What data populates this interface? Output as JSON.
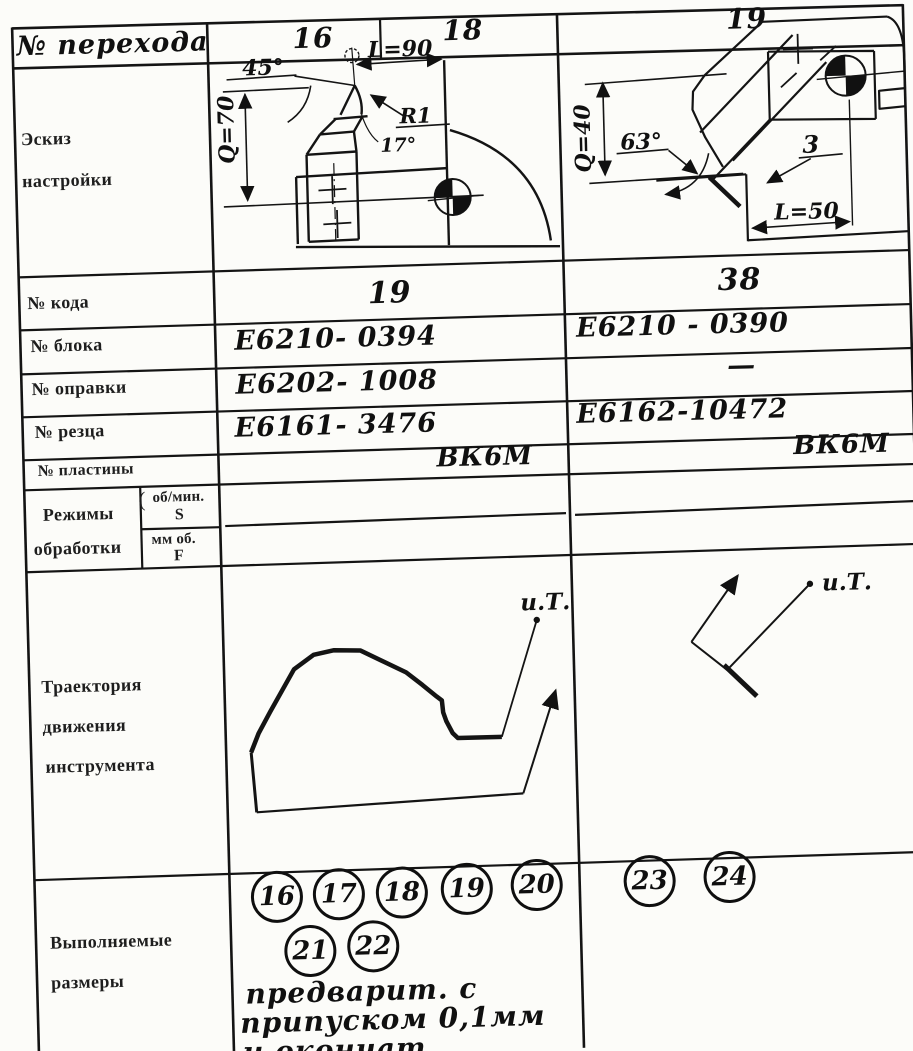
{
  "header": {
    "label": "№ перехода",
    "col1_left": "16",
    "col1_right": "18",
    "col2": "19"
  },
  "sketch_row": {
    "label_lines": [
      "Эскиз",
      "настройки"
    ],
    "col1": {
      "angle": "45°",
      "length": "L=90",
      "radius": "R1",
      "tip_angle": "17°",
      "height": "Q=70"
    },
    "col2": {
      "height": "Q=40",
      "angle": "63°",
      "offset": "3",
      "length": "L=50"
    }
  },
  "fields": [
    {
      "label": "№ кода",
      "col1": "19",
      "col2": "38"
    },
    {
      "label": "№ блока",
      "col1": "Е6210- 0394",
      "col2": "Е6210 - 0390"
    },
    {
      "label": "№ оправки",
      "col1": "Е6202- 1008",
      "col2": "—"
    },
    {
      "label": "№ резца",
      "col1": "Е6161- 3476",
      "col2": "Е6162-10472"
    },
    {
      "label": "№ пластины",
      "col1": "ВК6М",
      "col2": "ВК6М"
    }
  ],
  "modes": {
    "label_lines": [
      "Режимы",
      "обработки"
    ],
    "brace": "(",
    "spindle_unit": "об/мин.",
    "spindle_symbol": "S",
    "feed_unit": "мм об.",
    "feed_symbol": "F"
  },
  "trajectory": {
    "label_lines": [
      "Траектория",
      "движения",
      "инструмента"
    ],
    "col1_start_label": "и.Т.",
    "col2_start_label": "и.Т."
  },
  "dimensions": {
    "label_lines": [
      "Выполняемые",
      "размеры"
    ],
    "col1_circles_row1": [
      "16",
      "17",
      "18",
      "19",
      "20"
    ],
    "col1_circles_row2": [
      "21",
      "22"
    ],
    "col2_circles": [
      "23",
      "24"
    ],
    "note_lines": [
      "предварит. с",
      "припуском 0,1мм",
      "и окончат."
    ]
  }
}
